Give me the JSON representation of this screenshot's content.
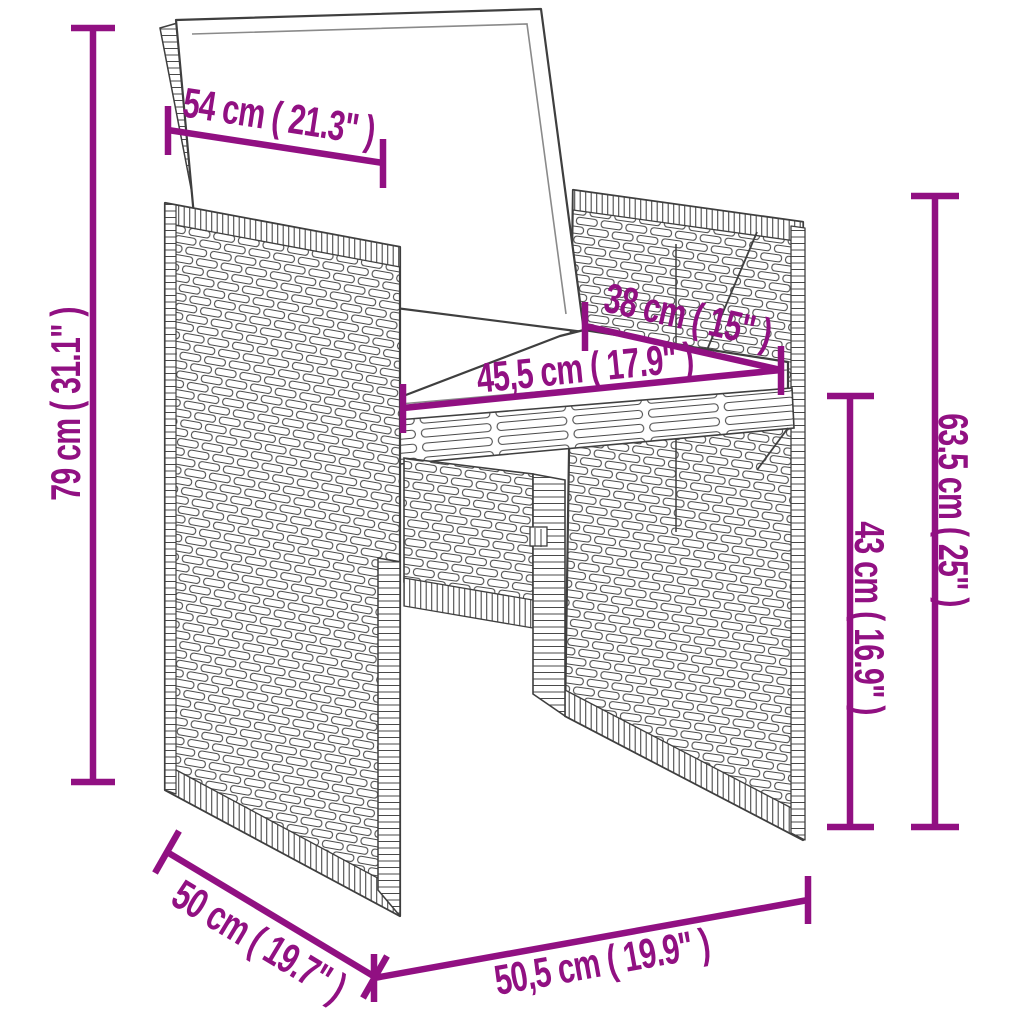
{
  "title": "Wicker chair with cushions - dimensions diagram",
  "colors": {
    "dimension_accent": "#911082",
    "line_art": "#3f3f3f",
    "cushion": "#ffffff",
    "background": "#ffffff"
  },
  "dimensions": {
    "back_width": {
      "label": "54 cm ( 21.3\" )"
    },
    "total_height": {
      "label": "79 cm ( 31.1\" )"
    },
    "backrest_height": {
      "label": "38 cm ( 15\" )"
    },
    "seat_width": {
      "label": "45,5 cm ( 17.9\" )"
    },
    "side_height": {
      "label": "63,5 cm ( 25\" )"
    },
    "seat_height": {
      "label": "43 cm ( 16.9\" )"
    },
    "seat_depth": {
      "label": "50 cm ( 19.7\" )"
    },
    "base_width": {
      "label": "50,5 cm ( 19.9\" )"
    }
  }
}
